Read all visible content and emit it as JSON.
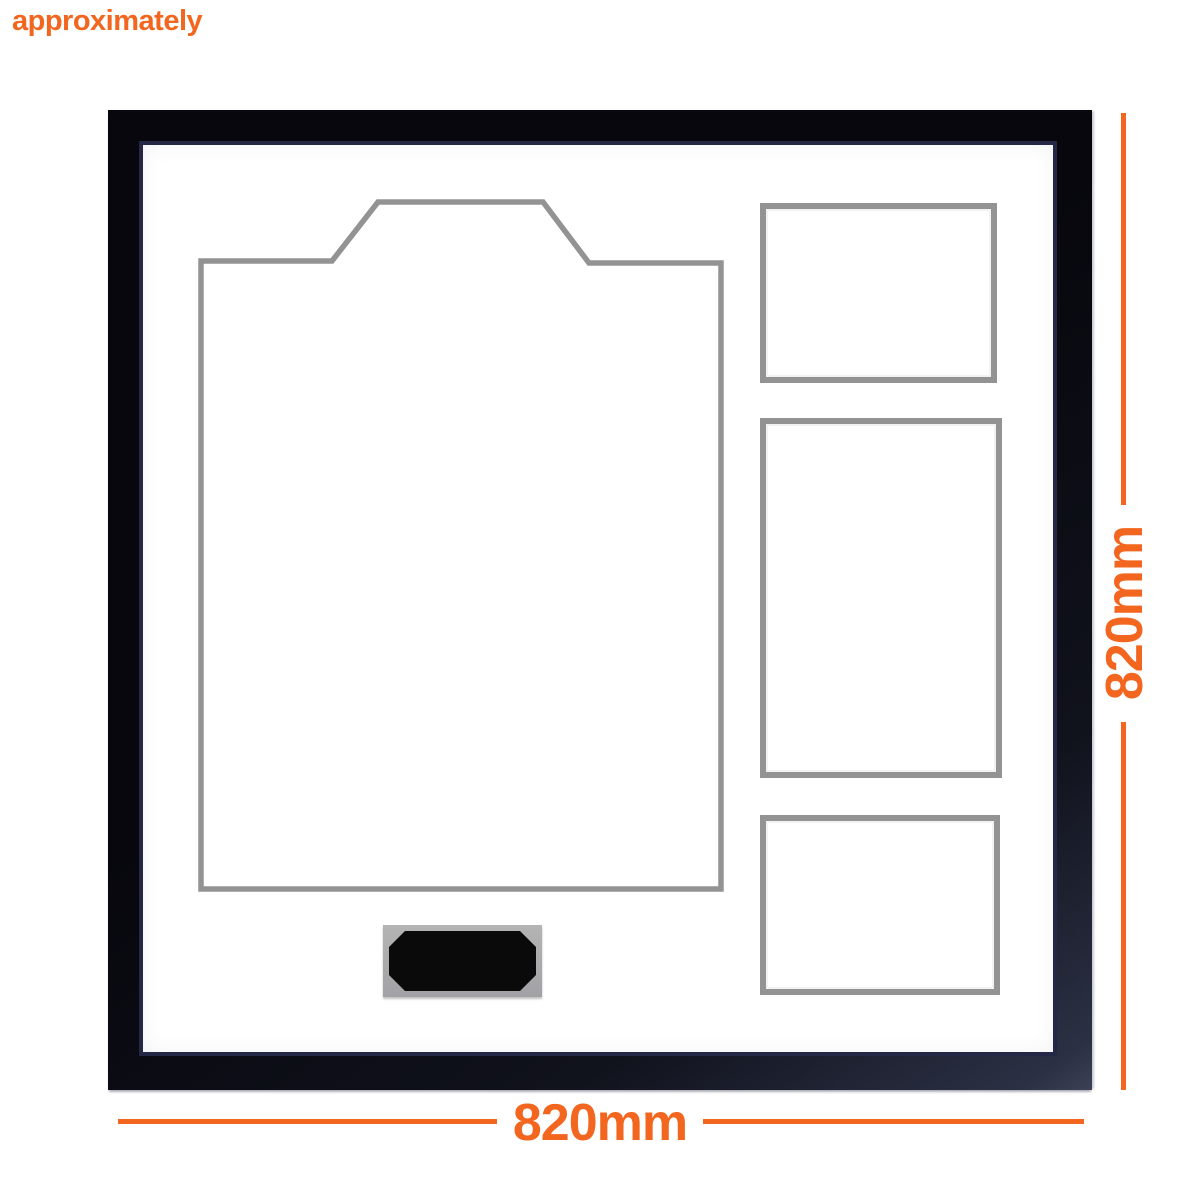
{
  "page": {
    "approx_note": "approximately"
  },
  "dimension_annotations": {
    "bottom": {
      "label": "820mm"
    },
    "right": {
      "label": "820mm"
    }
  },
  "frame": {
    "jersey_aperture_points": "58,116 189,116 235,57 400,57 446,118 578,118 578,744 58,744"
  },
  "colors": {
    "accent_orange": "#F2661F",
    "frame_black": "#0B0B12",
    "mat_white": "#FFFFFF",
    "bevel_gray": "#939393",
    "plaque_trim_gray": "#ABABAB",
    "plaque_face_black": "#0A0A0A"
  }
}
